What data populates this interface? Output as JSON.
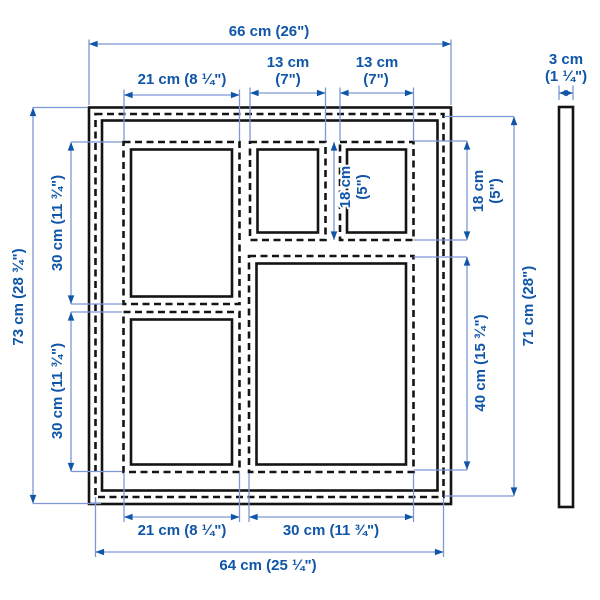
{
  "theme": {
    "accent": "#0f55a8",
    "dim-line": "#7e97d5",
    "frame-line": "#141414",
    "background": "#ffffff"
  },
  "diagram": {
    "type": "product dimension drawing",
    "views": {
      "front": "collage frame with five mat openings",
      "side": "frame depth profile"
    },
    "labels": {
      "top": {
        "overall_width": "66 cm (26\")",
        "left_opening_width": "21 cm (8 ¼\")",
        "small_opening_1_width_cm": "13 cm",
        "small_opening_1_width_in": "(7\")",
        "small_opening_2_width_cm": "13 cm",
        "small_opening_2_width_in": "(7\")"
      },
      "left": {
        "overall_height": "73 cm (28 ¾\")",
        "upper_opening_height": "30 cm (11 ¾\")",
        "lower_opening_height": "30 cm (11 ¾\")"
      },
      "right": {
        "small_opening_1_height_cm": "18 cm",
        "small_opening_1_height_in": "(5\")",
        "small_opening_2_height_cm": "18 cm",
        "small_opening_2_height_in": "(5\")",
        "large_opening_height": "40 cm (15 ¾\")",
        "inner_height": "71 cm (28\")"
      },
      "bottom": {
        "left_opening_width": "21 cm (8 ¼\")",
        "large_opening_width": "30 cm (11 ¾\")",
        "inner_width": "64 cm (25 ¼\")"
      },
      "side_profile": {
        "depth_cm": "3 cm",
        "depth_in": "(1 ¼\")"
      }
    }
  }
}
